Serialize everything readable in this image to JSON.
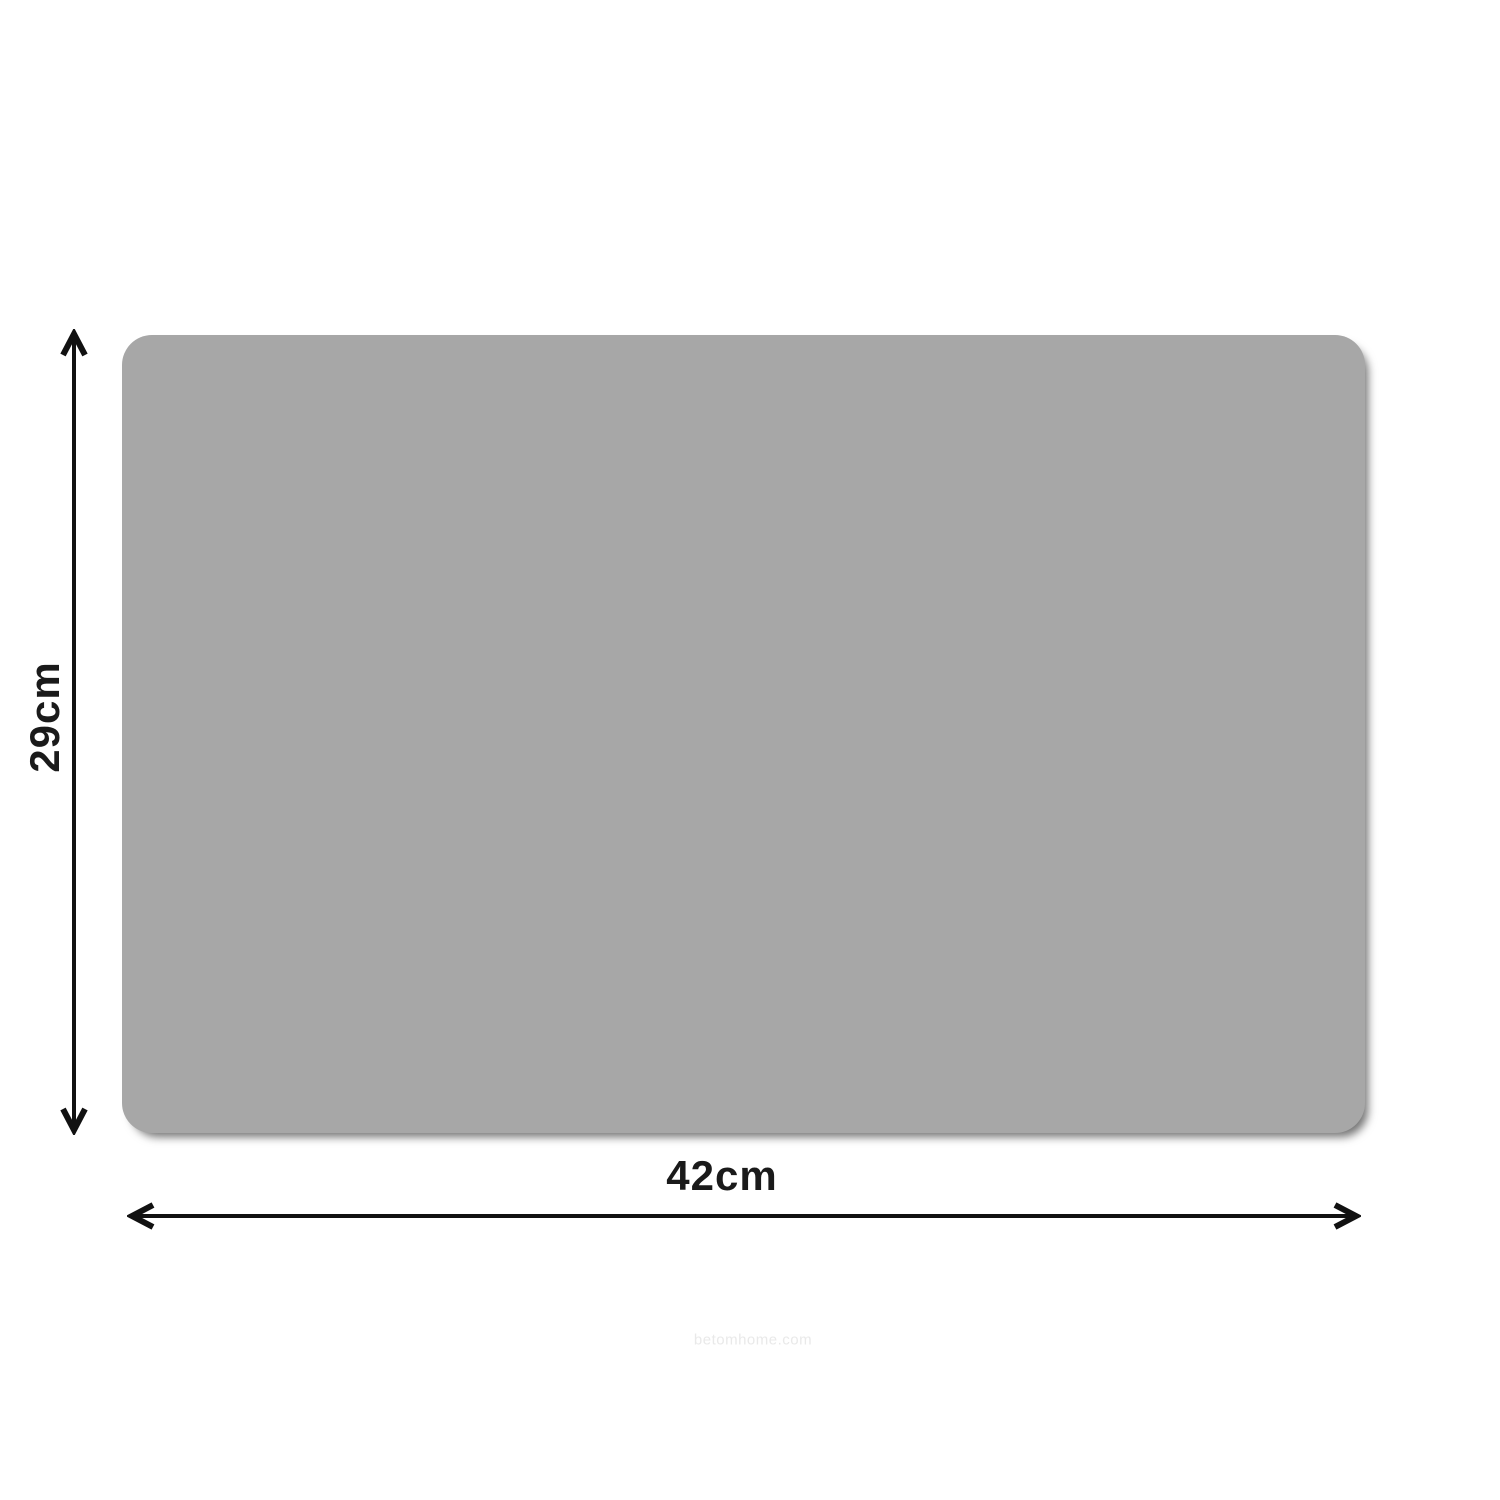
{
  "diagram": {
    "type": "product-dimension-diagram"
  },
  "labels": {
    "height": "29cm",
    "width": "42cm"
  },
  "watermark": {
    "text": "betomhome.com"
  },
  "colors": {
    "background": "#ffffff",
    "surface": "#a7a7a7",
    "arrow": "#111111",
    "text": "#1a1a1a",
    "watermark": "#e9e9e9"
  }
}
